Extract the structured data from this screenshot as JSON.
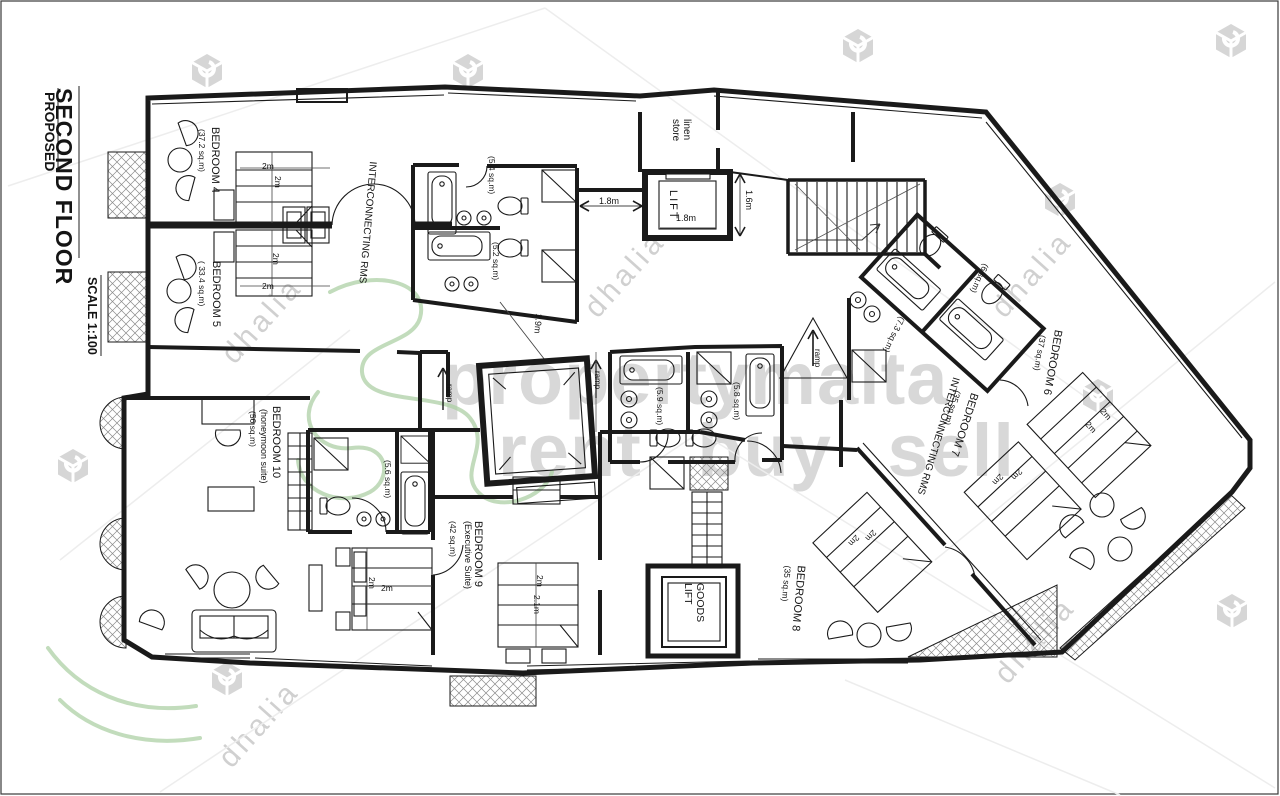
{
  "title_block": {
    "floor": "SECOND FLOOR",
    "status": "PROPOSED",
    "scale": "SCALE 1:100"
  },
  "rooms": {
    "bedroom4": {
      "name": "BEDROOM 4",
      "area": "(37.2 sq.m)"
    },
    "bedroom5": {
      "name": "BEDROOM 5",
      "area": "( 33.4 sq.m)"
    },
    "bedroom6": {
      "name": "BEDROOM 6",
      "area": "(37 sq.m)"
    },
    "bedroom7": {
      "name": "BEDROOM 7",
      "area": "(35 sq.m)"
    },
    "bedroom8": {
      "name": "BEDROOM 8",
      "area": "(35 sq.m)"
    },
    "bedroom9": {
      "name": "BEDROOM 9",
      "subtitle": "(Executive Suite)",
      "area": "(42 sq.m)"
    },
    "bedroom10": {
      "name": "BEDROOM 10",
      "subtitle": "(honeymoon suite)",
      "area": "(56 sq.m)"
    }
  },
  "core": {
    "lift": "LIFT",
    "goods_lift": "GOODS\nLIFT",
    "linen_store": "linen\nstore",
    "interconnecting_left": "INTERCONNECTING RMS",
    "interconnecting_right": "INTERCONNECTING RMS",
    "ramp": "ramp"
  },
  "bathrooms": {
    "bath1": "(5.4 sq.m)",
    "bath2": "(5.2 sq.m)",
    "bath3": "(6 sq.m)",
    "bath4": "(7.3 sq.m)",
    "bath5": "(5.9 sq.m)",
    "bath6": "(5.8 sq.m)",
    "bath7": "(5.6 sq.m)"
  },
  "dimensions": {
    "lift_width": "1.8m",
    "lift_width_inner": "1.8m",
    "lift_depth": "1.6m",
    "corridor": "1.9m",
    "bed_2m": "2m",
    "bed9_len": "2.1m"
  },
  "watermark": {
    "line1": "propertymalta",
    "line2": "rent buy sell",
    "brand": "dhalia"
  }
}
